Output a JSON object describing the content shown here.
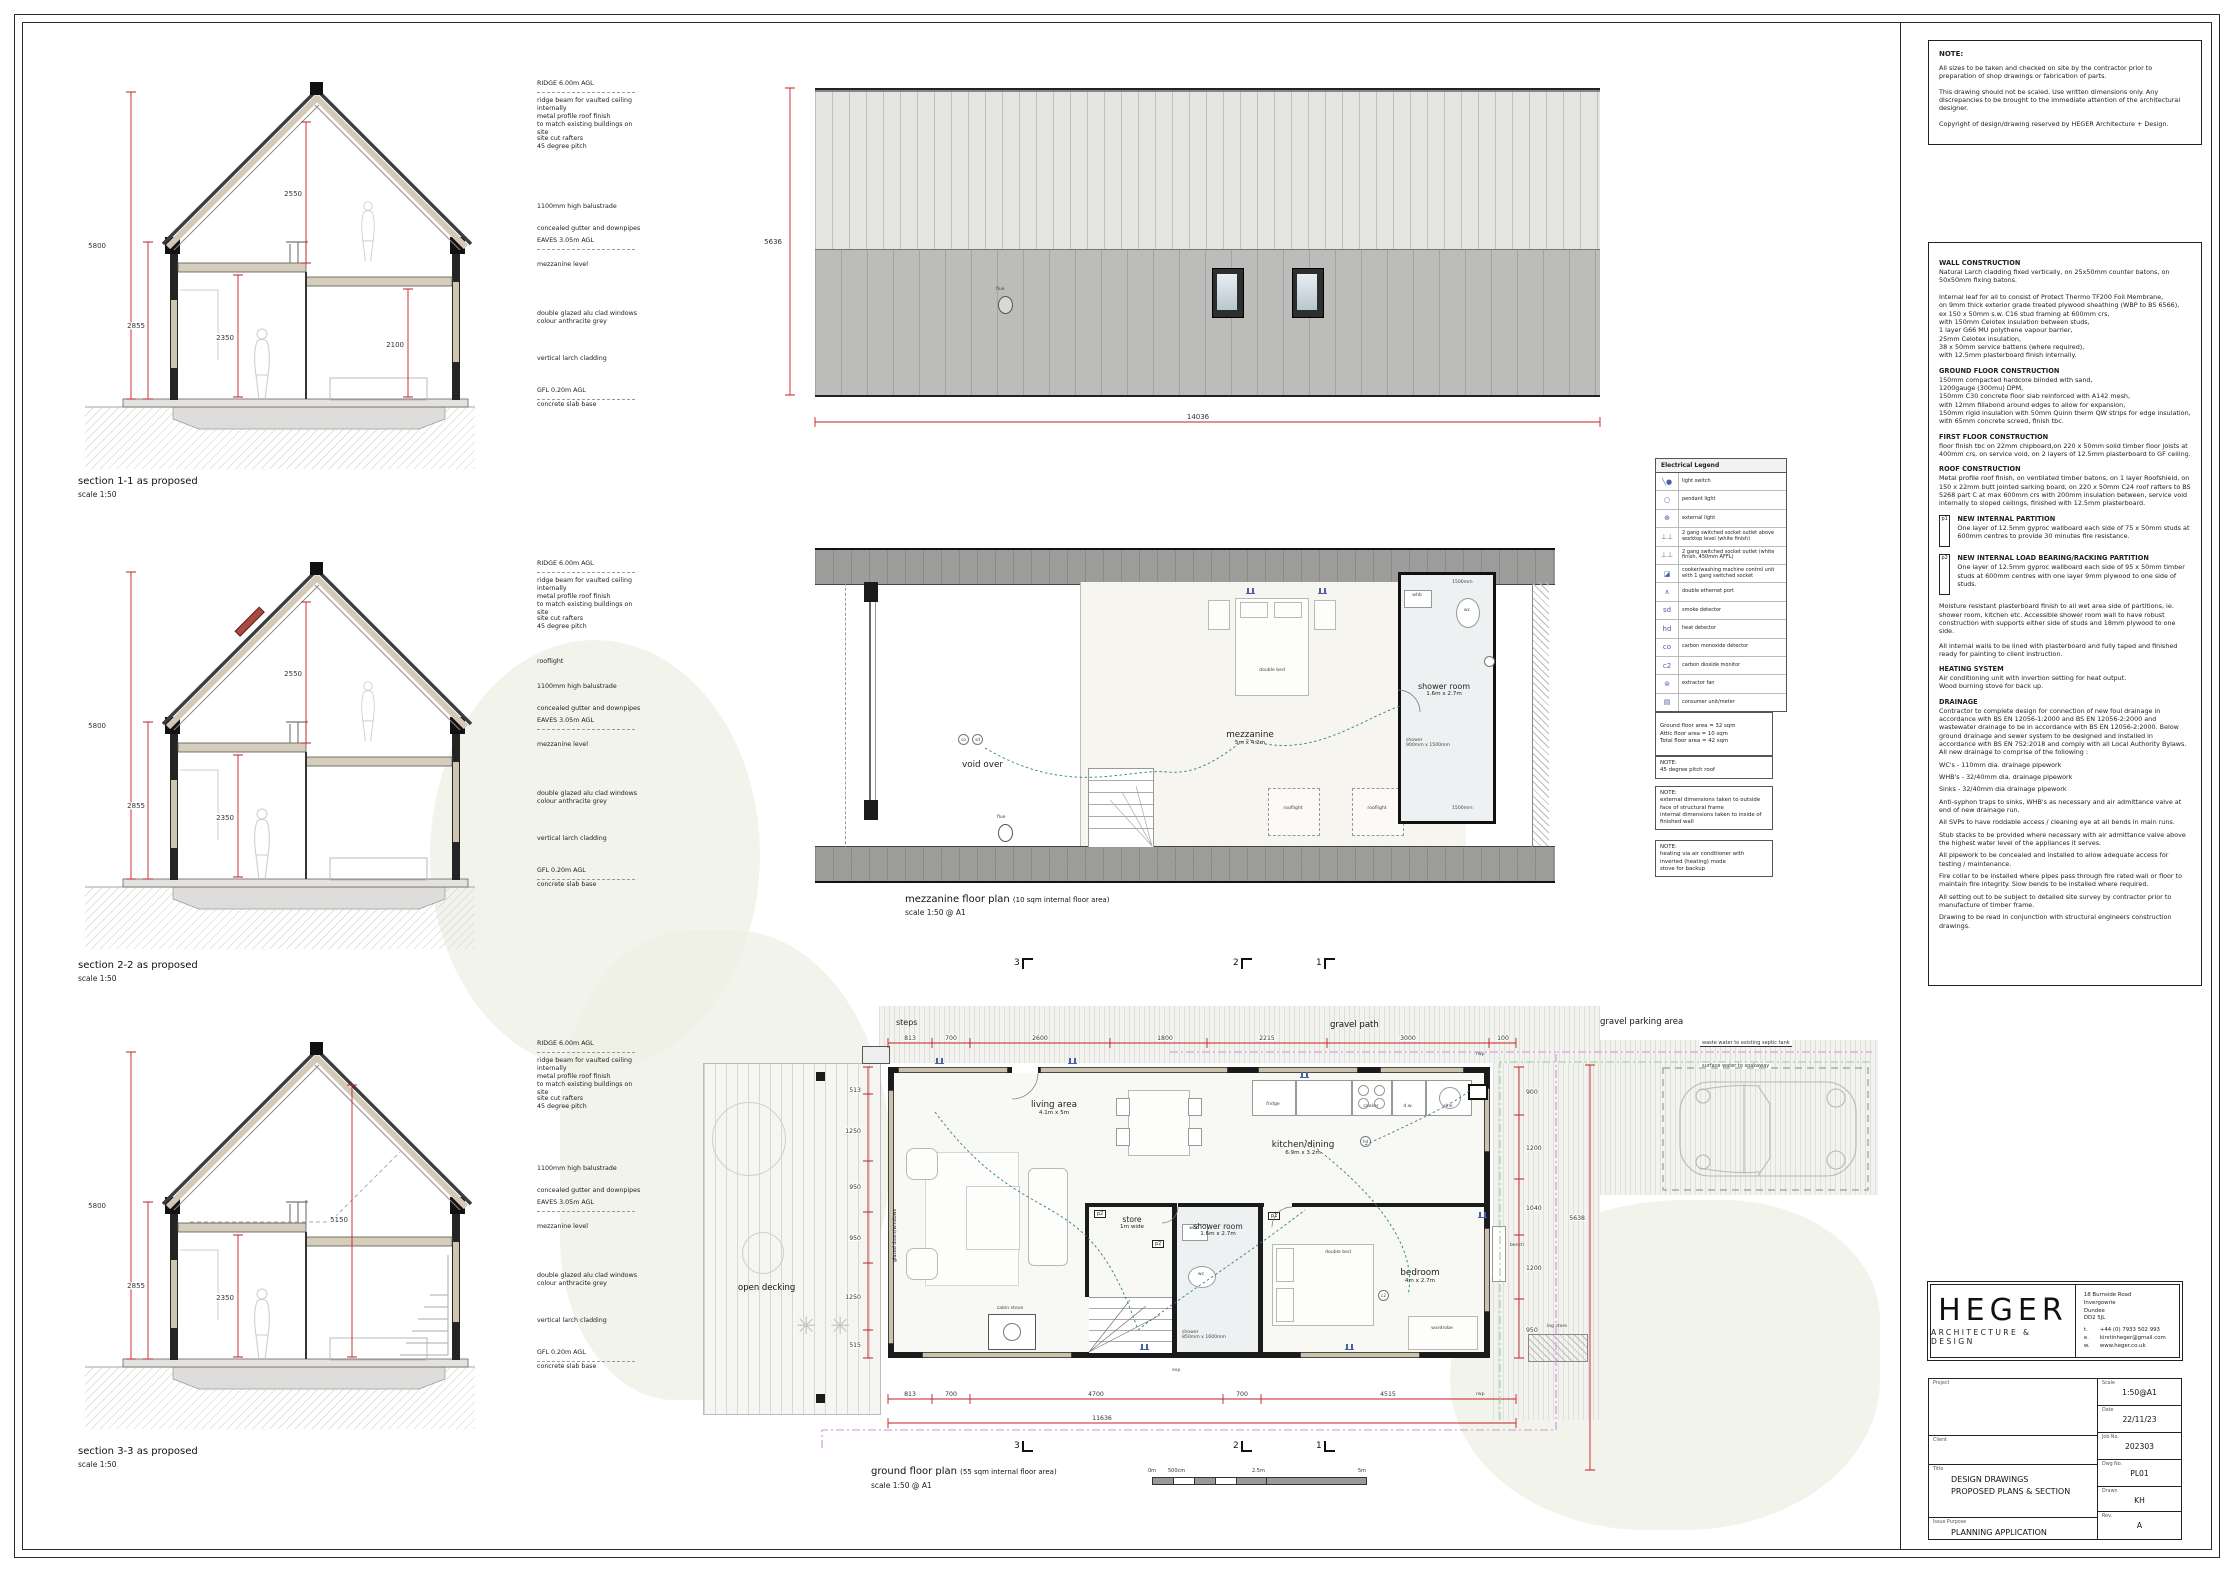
{
  "notes_box": {
    "heading": "NOTE:",
    "paragraphs": [
      "All sizes to be taken and checked on site by the contractor prior to preparation of shop drawings or fabrication of parts.",
      "This drawing should not be scaled. Use written dimensions only. Any discrepancies to be brought to the immediate attention of the architectural designer.",
      "Copyright of design/drawing reserved by HEGER Architecture + Design."
    ]
  },
  "construction": {
    "sections": [
      {
        "heading": "WALL CONSTRUCTION",
        "body": "Natural Larch cladding fixed vertically, on 25x50mm counter batons, on 50x50mm fixing batons.\n\nInternal leaf for all to consist of Protect Thermo TF200 Foil Membrane,\non 9mm thick exterior grade treated plywood sheathing (WBP to BS 6566),\nex 150 x 50mm s.w. C16 stud framing at 600mm crs,\nwith 150mm Celotex insulation between studs,\n1 layer G66 MU polythene vapour barrier,\n25mm Celotex insulation,\n38 x 50mm service battens (where required),\nwith 12.5mm plasterboard finish internally."
      },
      {
        "heading": "GROUND FLOOR CONSTRUCTION",
        "body": "150mm compacted hardcore blinded with sand,\n1200gauge (300mu) DPM,\n150mm C30 concrete floor slab reinforced with A142 mesh,\nwith 12mm fillabond around edges to allow for expansion,\n150mm rigid insulation with 50mm Quinn therm QW strips for edge insulation,\nwith 65mm concrete screed, finish tbc."
      },
      {
        "heading": "FIRST FLOOR CONSTRUCTION",
        "body": "floor finish tbc on 22mm chipboard,on 220 x 50mm solid timber floor joists at 400mm crs, on service void, on 2 layers of 12.5mm plasterboard to GF ceiling."
      },
      {
        "heading": "ROOF CONSTRUCTION",
        "body": "Metal profile roof finish, on ventilated timber batons, on 1 layer Roofshield, on 150 x 22mm butt jointed sarking board, on 220 x 50mm C24 roof rafters to BS 5268 part C at max 600mm crs with 200mm insulation between, service void internally to sloped ceilings, finished with 12.5mm plasterboard."
      }
    ],
    "partitions": [
      {
        "tag": "p1",
        "heading": "NEW INTERNAL PARTITION",
        "body": "One layer of 12.5mm gyproc wallboard each side of 75 x 50mm studs at 600mm centres to provide 30 minutes fire resistance."
      },
      {
        "tag": "p2",
        "heading": "NEW INTERNAL LOAD BEARING/RACKING PARTITION",
        "body": "One layer of 12.5mm gyproc wallboard each side of 95 x 50mm timber studs at 600mm centres with one layer 9mm plywood to one side of studs."
      }
    ],
    "extra_paragraphs": [
      "Moisture resistant plasterboard finish to all wet area side of partitions, ie. shower room, kitchen etc. Accessible shower room wall to have robust construction with supports either side of studs and 18mm plywood to one side.",
      "All internal walls to be lined with plasterboard and fully taped and finished ready for painting to client instruction."
    ],
    "heating": {
      "heading": "HEATING SYSTEM",
      "body": "Air conditioning unit with invertion setting for heat output.\nWood burning stove for back up."
    },
    "drainage": {
      "heading": "DRAINAGE",
      "paragraphs": [
        "Contractor to complete design for connection of new foul drainage in accordance with BS EN 12056-1:2000 and BS EN 12056-2:2000 and wastewater drainage to be in accordance with BS EN 12056-2:2000. Below ground drainage and sewer system to be designed and installed in accordance with BS EN 752:2018 and comply with all Local Authority Bylaws. All new drainage to comprise of the following :",
        "WC's - 110mm dia. drainage pipework",
        "WHB's - 32/40mm dia. drainage pipework",
        "Sinks - 32/40mm dia drainage pipework",
        "Anti-syphon traps to sinks, WHB's as necessary and air admittance valve at end of new drainage run.",
        "All SVPs to have roddable access / cleaning eye at all bends in main runs.",
        "Stub stacks to be provided where necessary with air admittance valve above the highest water level of the appliances it serves.",
        "All pipework to be concealed and installed to allow adequate access for testing / maintenance.",
        "Fire collar to be installed where pipes pass through fire rated wall or floor to maintain fire integrity.  Slow bends to be installed where required.",
        "All setting out to be subject to detailed site survey by contractor prior to manufacture of timber frame.",
        "Drawing to be read in conjunction with structural engineers construction drawings."
      ]
    }
  },
  "legend": {
    "title": "Electrical Legend",
    "rows": [
      {
        "sym": "╲●",
        "label": "light switch"
      },
      {
        "sym": "○",
        "label": "pendant light"
      },
      {
        "sym": "⊕",
        "label": "external light"
      },
      {
        "sym": "⊥⊥",
        "label": "2 gang switched socket outlet above worktop level (white finish)"
      },
      {
        "sym": "⊥⊥",
        "label": "2 gang switched socket outlet (white finish, 450mm AFFL)"
      },
      {
        "sym": "◪",
        "label": "cooker/washing machine control unit with 1 gang switched socket"
      },
      {
        "sym": "∧",
        "label": "double ethernet port"
      },
      {
        "sym": "sd",
        "label": "smoke detector"
      },
      {
        "sym": "hd",
        "label": "heat detector"
      },
      {
        "sym": "co",
        "label": "carbon monoxide detector"
      },
      {
        "sym": "c2",
        "label": "carbon dioxide monitor"
      },
      {
        "sym": "⊚",
        "label": "extractor fan"
      },
      {
        "sym": "▤",
        "label": "consumer unit/meter"
      }
    ]
  },
  "area_notes": {
    "areas": [
      "Ground floor area = 32 sqm",
      "Attic floor area = 10 sqm",
      "Total floor area = 42 sqm"
    ],
    "note1": "NOTE:\n45 degree pitch roof",
    "note2": "NOTE:\nexternal dimensions taken to outside face of structural frame\ninternal dimensions taken to inside of finished wall",
    "note3": "NOTE:\nheating via air conditioner with inverted (heating) mode\nstove for backup"
  },
  "sections": {
    "annotations": [
      "RIDGE 6.00m AGL",
      "ridge beam for vaulted ceiling internally",
      "metal profile roof finish\nto match existing buildings on site",
      "site cut rafters\n45 degree pitch",
      "rooflight",
      "1100mm high balustrade",
      "concealed gutter and downpipes",
      "EAVES 3.05m AGL",
      "mezzanine level",
      "double glazed alu clad windows\ncolour anthracite grey",
      "vertical larch cladding",
      "GFL 0.20m AGL",
      "concrete slab base"
    ],
    "s1": {
      "caption": "section 1-1 as proposed",
      "scale": "scale 1:50",
      "dims": [
        "5800",
        "2855",
        "2550",
        "2350",
        "2100"
      ]
    },
    "s2": {
      "caption": "section 2-2 as proposed",
      "scale": "scale 1:50",
      "dims": [
        "5800",
        "2855",
        "2550",
        "2350"
      ]
    },
    "s3": {
      "caption": "section 3-3 as proposed",
      "scale": "scale 1:50",
      "dims": [
        "5800",
        "2855",
        "2350",
        "5150"
      ]
    }
  },
  "roof_plan": {
    "dim_h": "5636",
    "dim_w": "14036",
    "flue": "flue"
  },
  "mezzanine": {
    "void_over": "void over",
    "name": "mezzanine",
    "size": "5m x 4.2m",
    "double_bed": "double bed",
    "shower_name": "shower room",
    "shower_size": "1.6m x 2.7m",
    "whb": "whb",
    "wc": "wc",
    "shower_tray": "shower\n900mm x 1500mm",
    "d1500": "1500mm",
    "rooflight": "rooflight",
    "flue": "flue",
    "co": "co",
    "sd": "sd",
    "caption": "mezzanine floor plan",
    "caption_suffix": "(10 sqm internal floor area)",
    "scale_label": "scale 1:50 @ A1"
  },
  "ground": {
    "open_decking": "open decking",
    "steps": "steps",
    "gravel_path": "gravel path",
    "gravel_parking": "gravel parking area",
    "living_name": "living area",
    "living_size": "4.1m x 5m",
    "kitchen_name": "kitchen/dining",
    "kitchen_size": "6.9m x 3.2m",
    "store_name": "store",
    "store_size": "1m wide",
    "shower_name": "shower room",
    "shower_size": "1.6m x 2.7m",
    "shower_tray": "shower\n850mm x 1600mm",
    "bedroom_name": "bedroom",
    "bedroom_size": "4m x 2.7m",
    "double_bed": "double bed",
    "wardrobe": "wardrobe",
    "cabin_stove": "cabin stove",
    "fridge": "fridge",
    "cooker": "cooker",
    "dw": "d.w.",
    "sink": "sink",
    "bench": "bench",
    "log_store": "log store",
    "glazed": "glazed doors/windows",
    "waste_water": "waste water to existing septic tank",
    "surface_water": "surface water to soakaway",
    "p1": "p1",
    "p2": "p2",
    "hd": "hd",
    "c2": "c2",
    "exp": "exp",
    "rwp": "rwp",
    "markers": [
      "3",
      "2",
      "1"
    ],
    "dims_top": [
      "813",
      "700",
      "2600",
      "1800",
      "2215",
      "3000",
      "100"
    ],
    "dims_bottom": [
      "813",
      "700",
      "4700",
      "700",
      "4515"
    ],
    "dims_left": [
      "513",
      "1250",
      "950",
      "950",
      "1250",
      "515"
    ],
    "dims_right": [
      "900",
      "1200",
      "1040",
      "1200",
      "950"
    ],
    "overall_w": "11636",
    "overall_h": "5638",
    "caption": "ground floor plan",
    "caption_suffix": "(55 sqm internal floor area)",
    "scale_label": "scale 1:50 @ A1",
    "scalebar": [
      "0m",
      "500cm",
      "2.5m",
      "5m"
    ]
  },
  "branding": {
    "name": "HEGER",
    "sub": "ARCHITECTURE & DESIGN",
    "address": [
      "18 Burnside Road",
      "Invergowrie",
      "Dundee",
      "DD2 5JL"
    ],
    "contacts": [
      {
        "k": "t.",
        "v": "+44 (0) 7933 502 993"
      },
      {
        "k": "e.",
        "v": "kirstinheger@gmail.com"
      },
      {
        "k": "w.",
        "v": "www.heger.co.uk"
      }
    ]
  },
  "title_block": {
    "project_label": "Project",
    "client_label": "Client",
    "title_label": "Title",
    "issue_label": "Issue Purpose",
    "scale_label": "Scale",
    "date_label": "Date",
    "job_label": "Job No.",
    "dwg_label": "Dwg No.",
    "drawn_label": "Drawn",
    "rev_label": "Rev.",
    "title1": "DESIGN DRAWINGS",
    "title2": "PROPOSED PLANS & SECTION",
    "issue": "PLANNING APPLICATION",
    "scale": "1:50@A1",
    "date": "22/11/23",
    "job": "202303",
    "dwg": "PL01",
    "drawn": "KH",
    "rev": "A"
  }
}
